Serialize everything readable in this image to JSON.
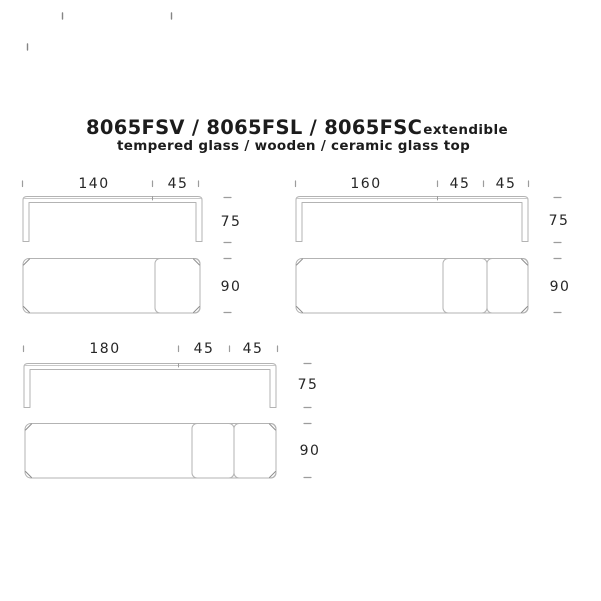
{
  "title": {
    "models": "8065FSV / 8065FSL / 8065FSC",
    "tag": "extendible",
    "subtitle": "tempered glass / wooden / ceramic glass top"
  },
  "figures": [
    {
      "name": "table-140",
      "top_dims": [
        "140",
        "45"
      ],
      "height": "75",
      "depth": "90"
    },
    {
      "name": "table-160",
      "top_dims": [
        "160",
        "45",
        "45"
      ],
      "height": "75",
      "depth": "90"
    },
    {
      "name": "table-180",
      "top_dims": [
        "180",
        "45",
        "45"
      ],
      "height": "75",
      "depth": "90"
    }
  ],
  "colors": {
    "background": "#ffffff",
    "line": "#b3b3b3",
    "line_dark": "#8d8d8d",
    "tick": "#9c9c9c",
    "text": "#1c1c1c"
  }
}
